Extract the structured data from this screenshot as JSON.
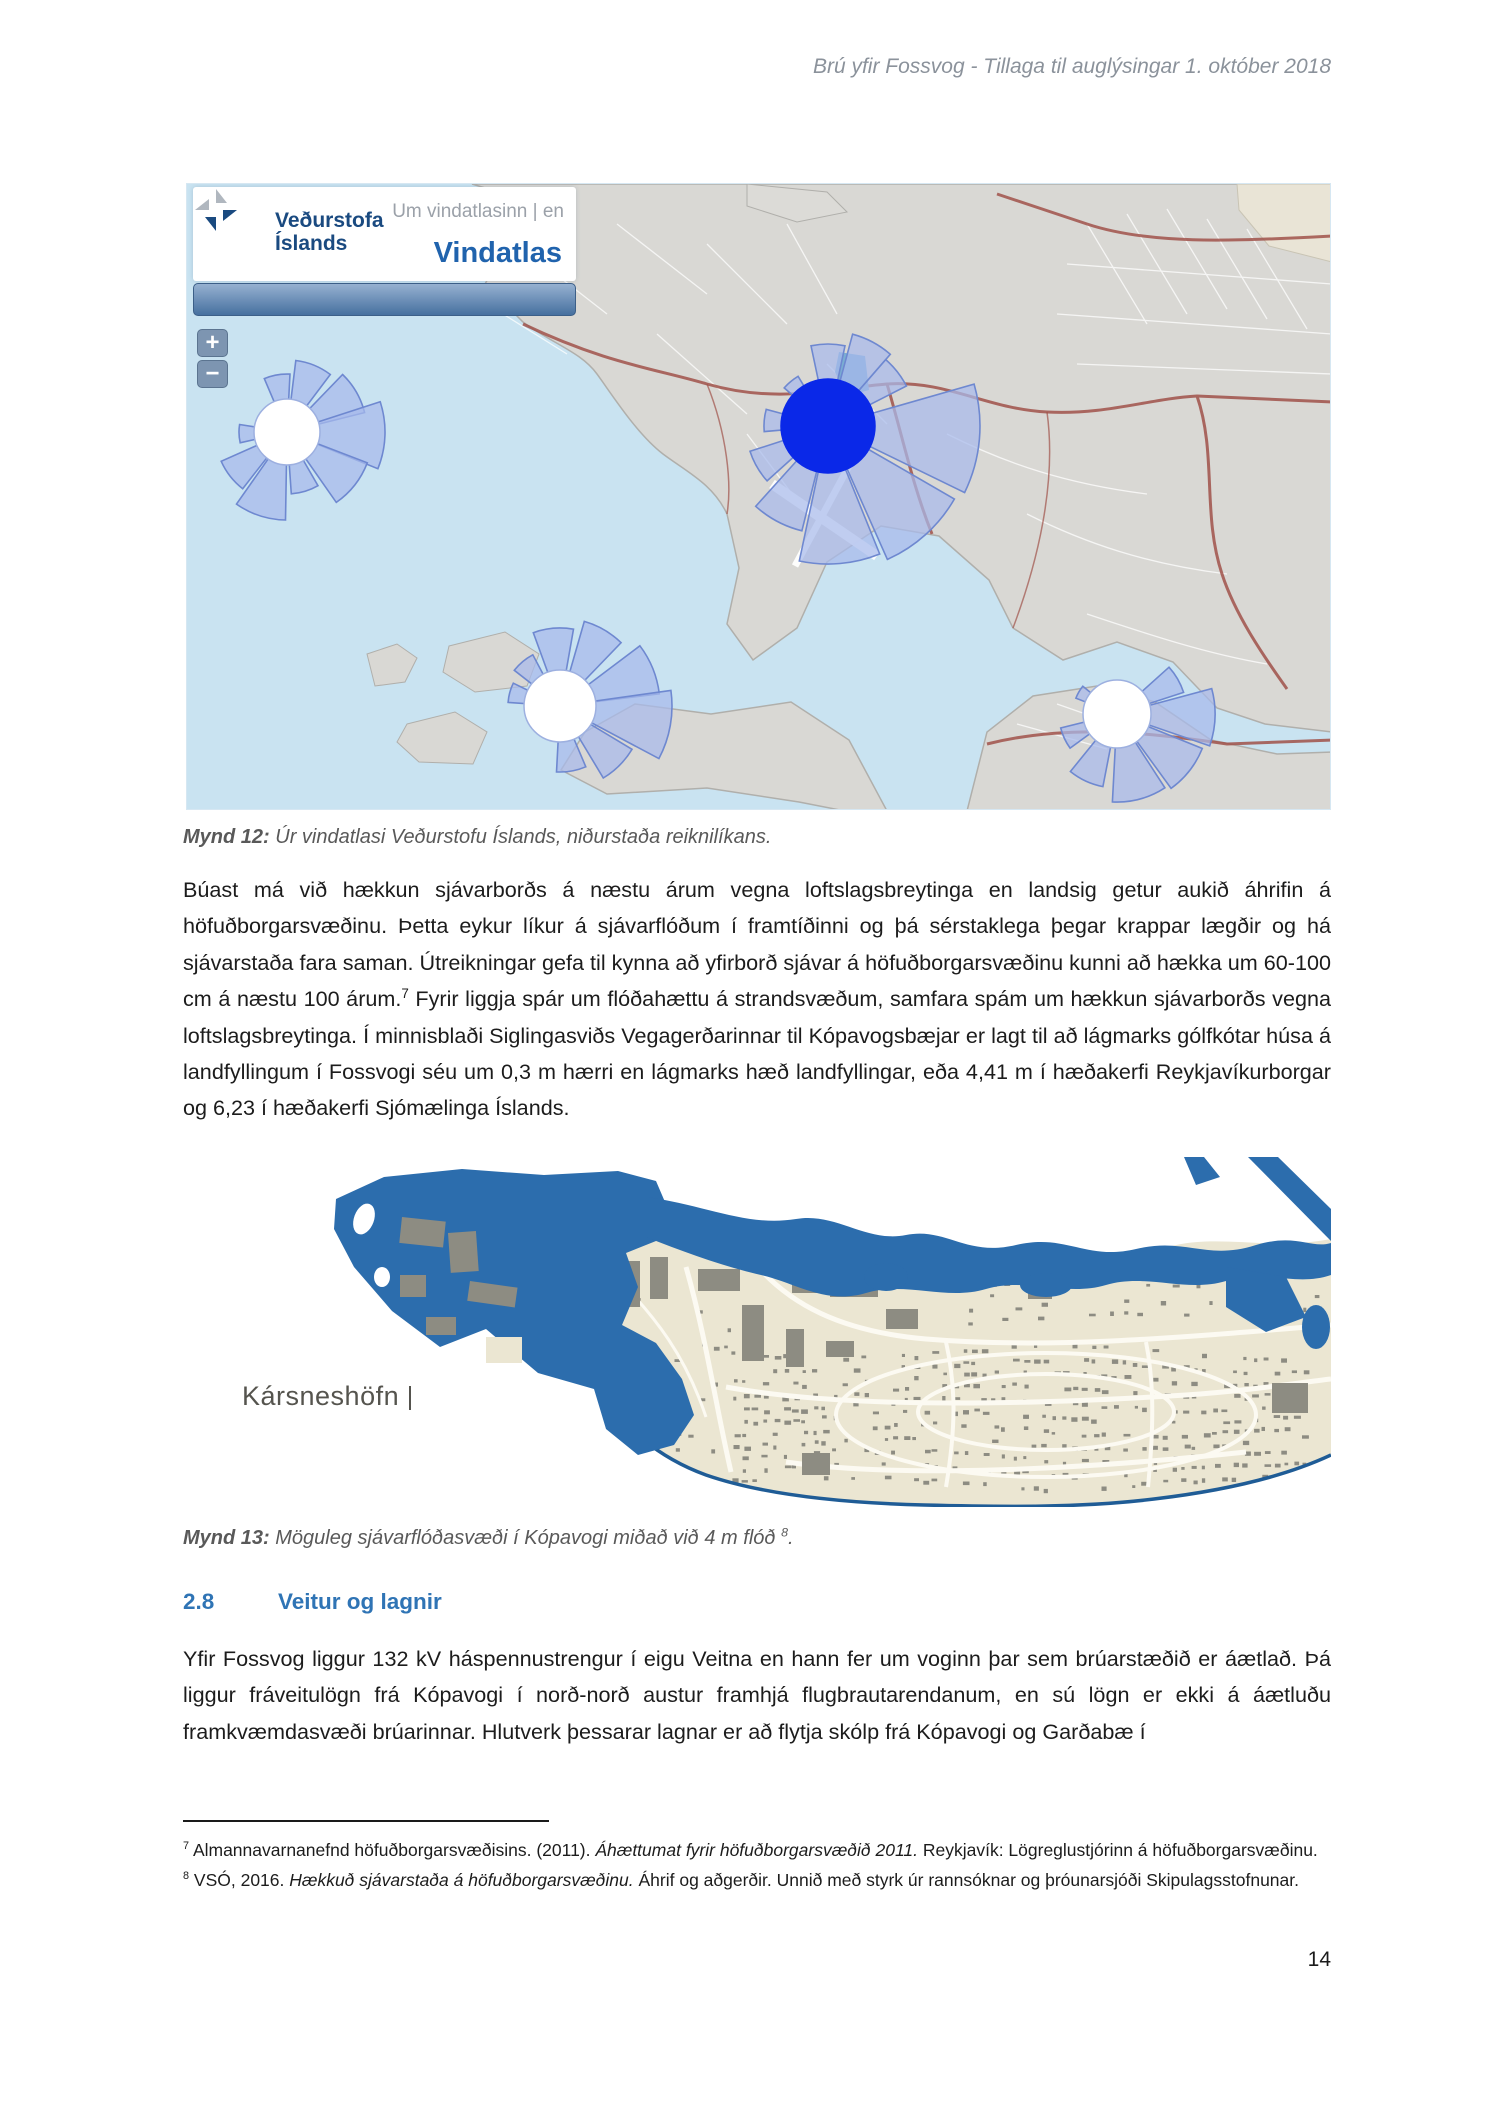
{
  "header": {
    "text": "Brú yfir Fossvog - Tillaga til auglýsingar 1. október 2018"
  },
  "figure1": {
    "logo_line1": "Veðurstofa",
    "logo_line2": "Íslands",
    "nav_link": "Um vindatlasinn | en",
    "site_title": "Vindatlas",
    "zoom_in": "+",
    "zoom_out": "−",
    "caption_label": "Mynd 12:",
    "caption_text": " Úr vindatlasi Veðurstofu Íslands, niðurstaða reiknilíkans."
  },
  "paragraph1": {
    "part1": "Búast má við hækkun sjávarborðs á næstu árum vegna loftslagsbreytinga en landsig getur aukið áhrifin á höfuðborgarsvæðinu. Þetta eykur líkur á sjávarflóðum í framtíðinni og þá sérstaklega þegar krappar lægðir og há sjávarstaða fara saman. Útreikningar gefa til kynna að yfirborð sjávar á höfuðborgarsvæðinu kunni að hækka um 60-100 cm á næstu 100 árum.",
    "sup": "7",
    "part2": " Fyrir liggja spár um flóðahættu á strandsvæðum, samfara spám um hækkun sjávarborðs vegna loftslagsbreytinga. Í minnisblaði Siglingasviðs Vegagerðarinnar til Kópavogsbæjar er lagt til að lágmarks gólfkótar húsa á landfyllingum í Fossvogi séu um 0,3 m hærri en lágmarks hæð landfyllingar, eða 4,41 m í hæðakerfi Reykjavíkurborgar og 6,23 í hæðakerfi Sjómælinga Íslands."
  },
  "figure2": {
    "map_label": "Kársneshöfn",
    "caption_label": "Mynd 13:",
    "caption_text": " Möguleg sjávarflóðasvæði í Kópavogi miðað við 4 m flóð ",
    "caption_sup": "8",
    "caption_period": "."
  },
  "section28": {
    "number": "2.8",
    "title": "Veitur og lagnir"
  },
  "paragraph2": {
    "text": "Yfir Fossvog liggur 132 kV háspennustrengur í eigu Veitna en hann fer um voginn þar sem brúarstæðið er áætlað. Þá liggur fráveitulögn frá Kópavogi í norð-norð austur framhjá flugbrautarendanum, en sú lögn er ekki á áætluðu framkvæmdasvæði brúarinnar. Hlutverk þessarar lagnar er að flytja skólp frá Kópavogi og Garðabæ í"
  },
  "footnotes": {
    "items": [
      {
        "ref": "7",
        "pre": "Almannavarnanefnd höfuðborgarsvæðisins. (2011). ",
        "italic": "Áhættumat fyrir höfuðborgarsvæðið 2011.",
        "post": " Reykjavík: Lögreglustjórinn á höfuðborgarsvæðinu."
      },
      {
        "ref": "8",
        "pre": "VSÓ, 2016. ",
        "italic": "Hækkuð sjávarstaða á höfuðborgarsvæðinu.",
        "post": " Áhrif og aðgerðir. Unnið með styrk úr rannsóknar og þróunarsjóði Skipulagsstofnunar."
      }
    ]
  },
  "page_number": "14",
  "colors": {
    "heading_blue": "#2f74b5",
    "map1_water": "#c9e3f1",
    "map1_land": "#d9d8d4",
    "road_red": "#a0524a",
    "rose_petal": "#a8baec",
    "rose_petal_stroke": "#6e88d0",
    "rose_center_dark": "#0a28e8",
    "flood_blue": "#2c6dad",
    "map2_land": "#ebe6d2",
    "map2_building": "#8d8c82"
  }
}
